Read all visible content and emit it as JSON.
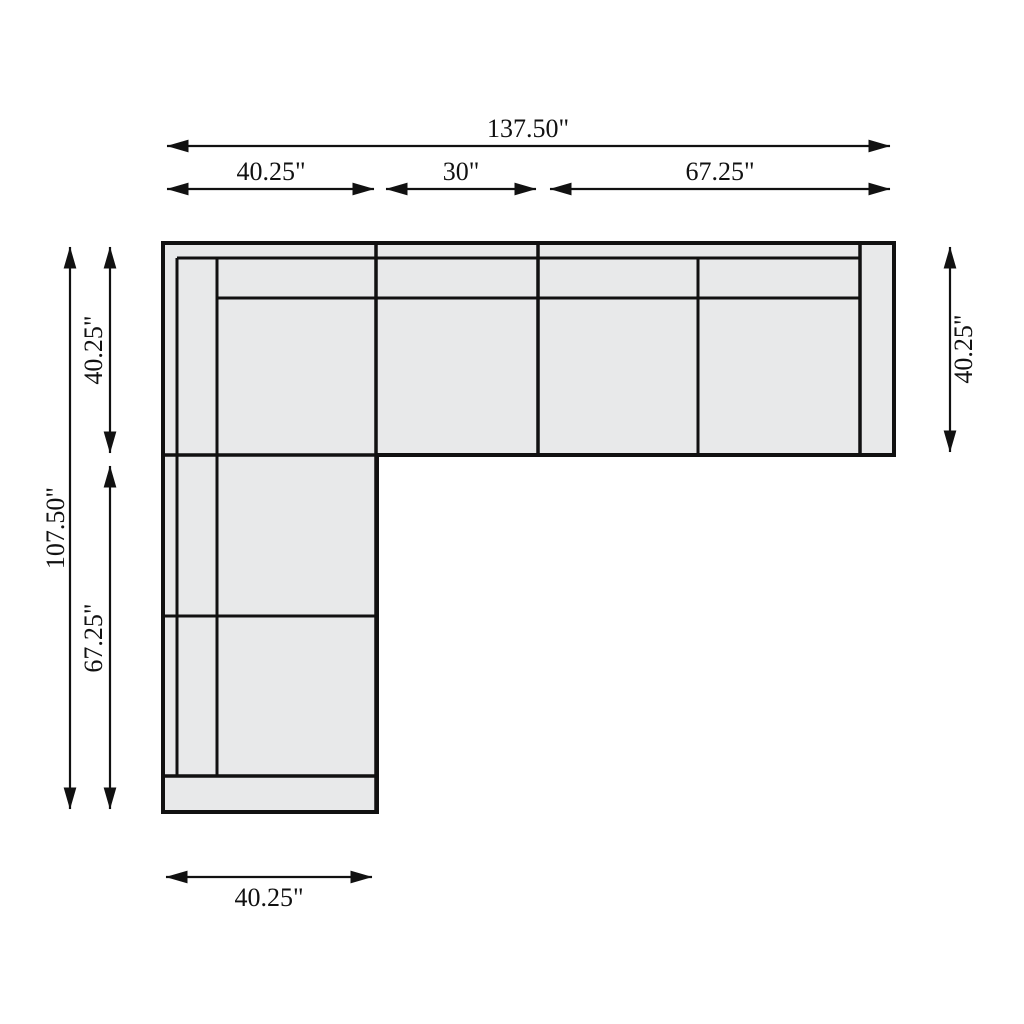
{
  "diagram": {
    "colors": {
      "background": "#ffffff",
      "sofa_fill": "#e8e9ea",
      "line": "#111111"
    },
    "dimensions": {
      "top_total": "137.50\"",
      "top_segment_1": "40.25\"",
      "top_segment_2": "30\"",
      "top_segment_3": "67.25\"",
      "left_total": "107.50\"",
      "left_segment_1": "40.25\"",
      "left_segment_2": "67.25\"",
      "right_side": "40.25\"",
      "bottom": "40.25\""
    }
  }
}
